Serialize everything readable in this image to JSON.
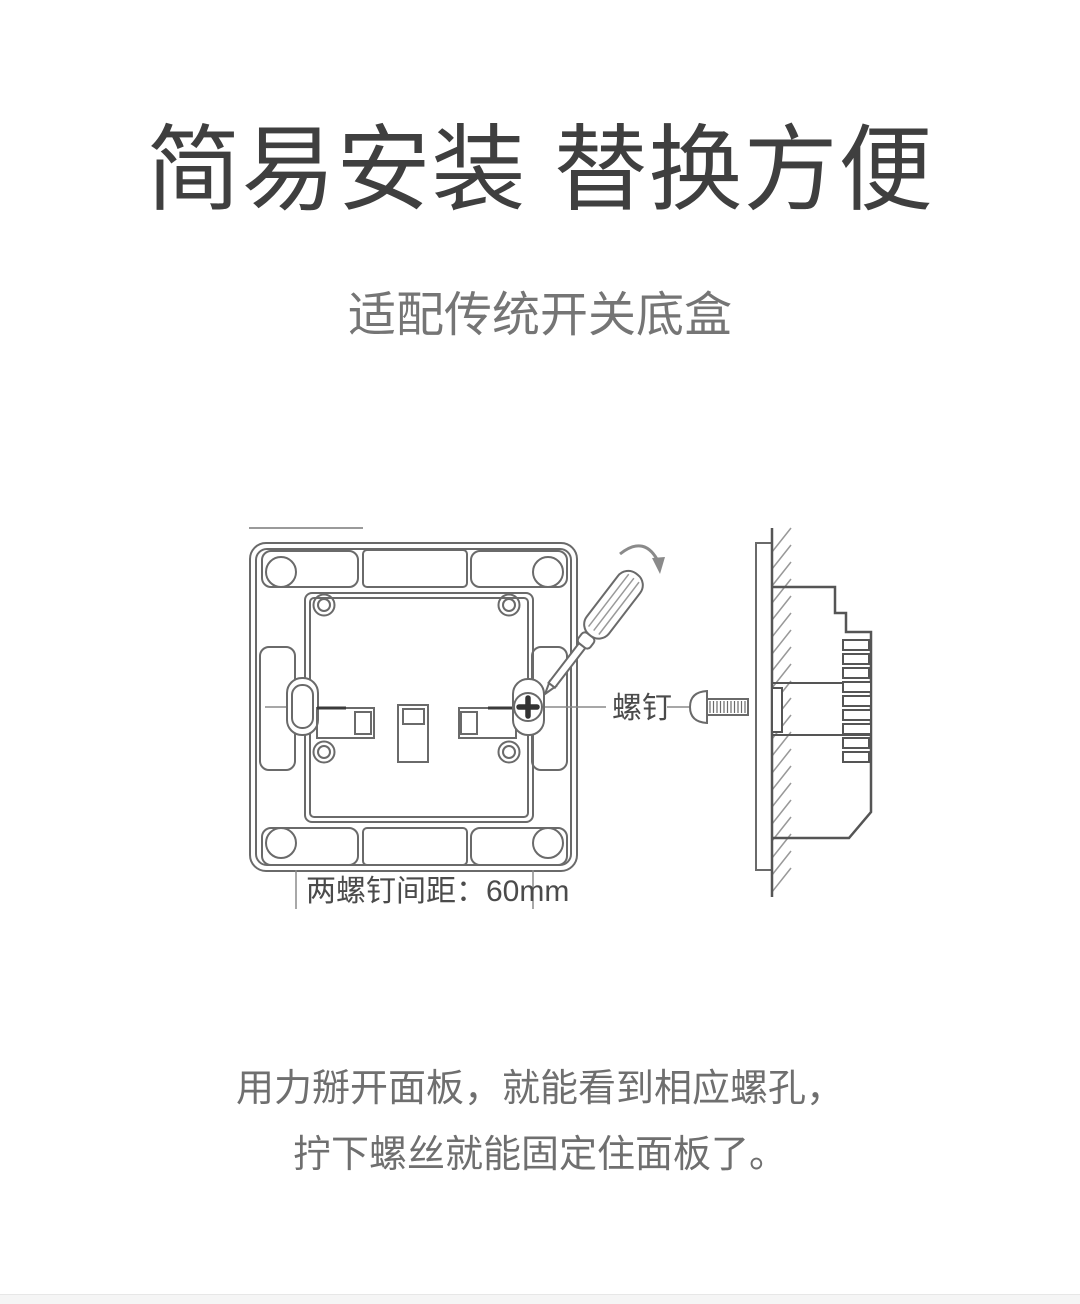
{
  "header": {
    "title": "简易安装 替换方便",
    "subtitle": "适配传统开关底盒"
  },
  "diagram": {
    "screw_label": "螺钉",
    "dimension_label": "两螺钉间距：60mm"
  },
  "description": {
    "line1": "用力掰开面板，就能看到相应螺孔，",
    "line2": "拧下螺丝就能固定住面板了。"
  },
  "colors": {
    "heading": "#3f3f3f",
    "subtitle": "#757575",
    "body_text": "#6f6f6f",
    "diagram_line": "#6a6a6a",
    "diagram_dark_line": "#555555",
    "label_text": "#4b4b4b",
    "footer_strip": "#f5f5f5"
  }
}
